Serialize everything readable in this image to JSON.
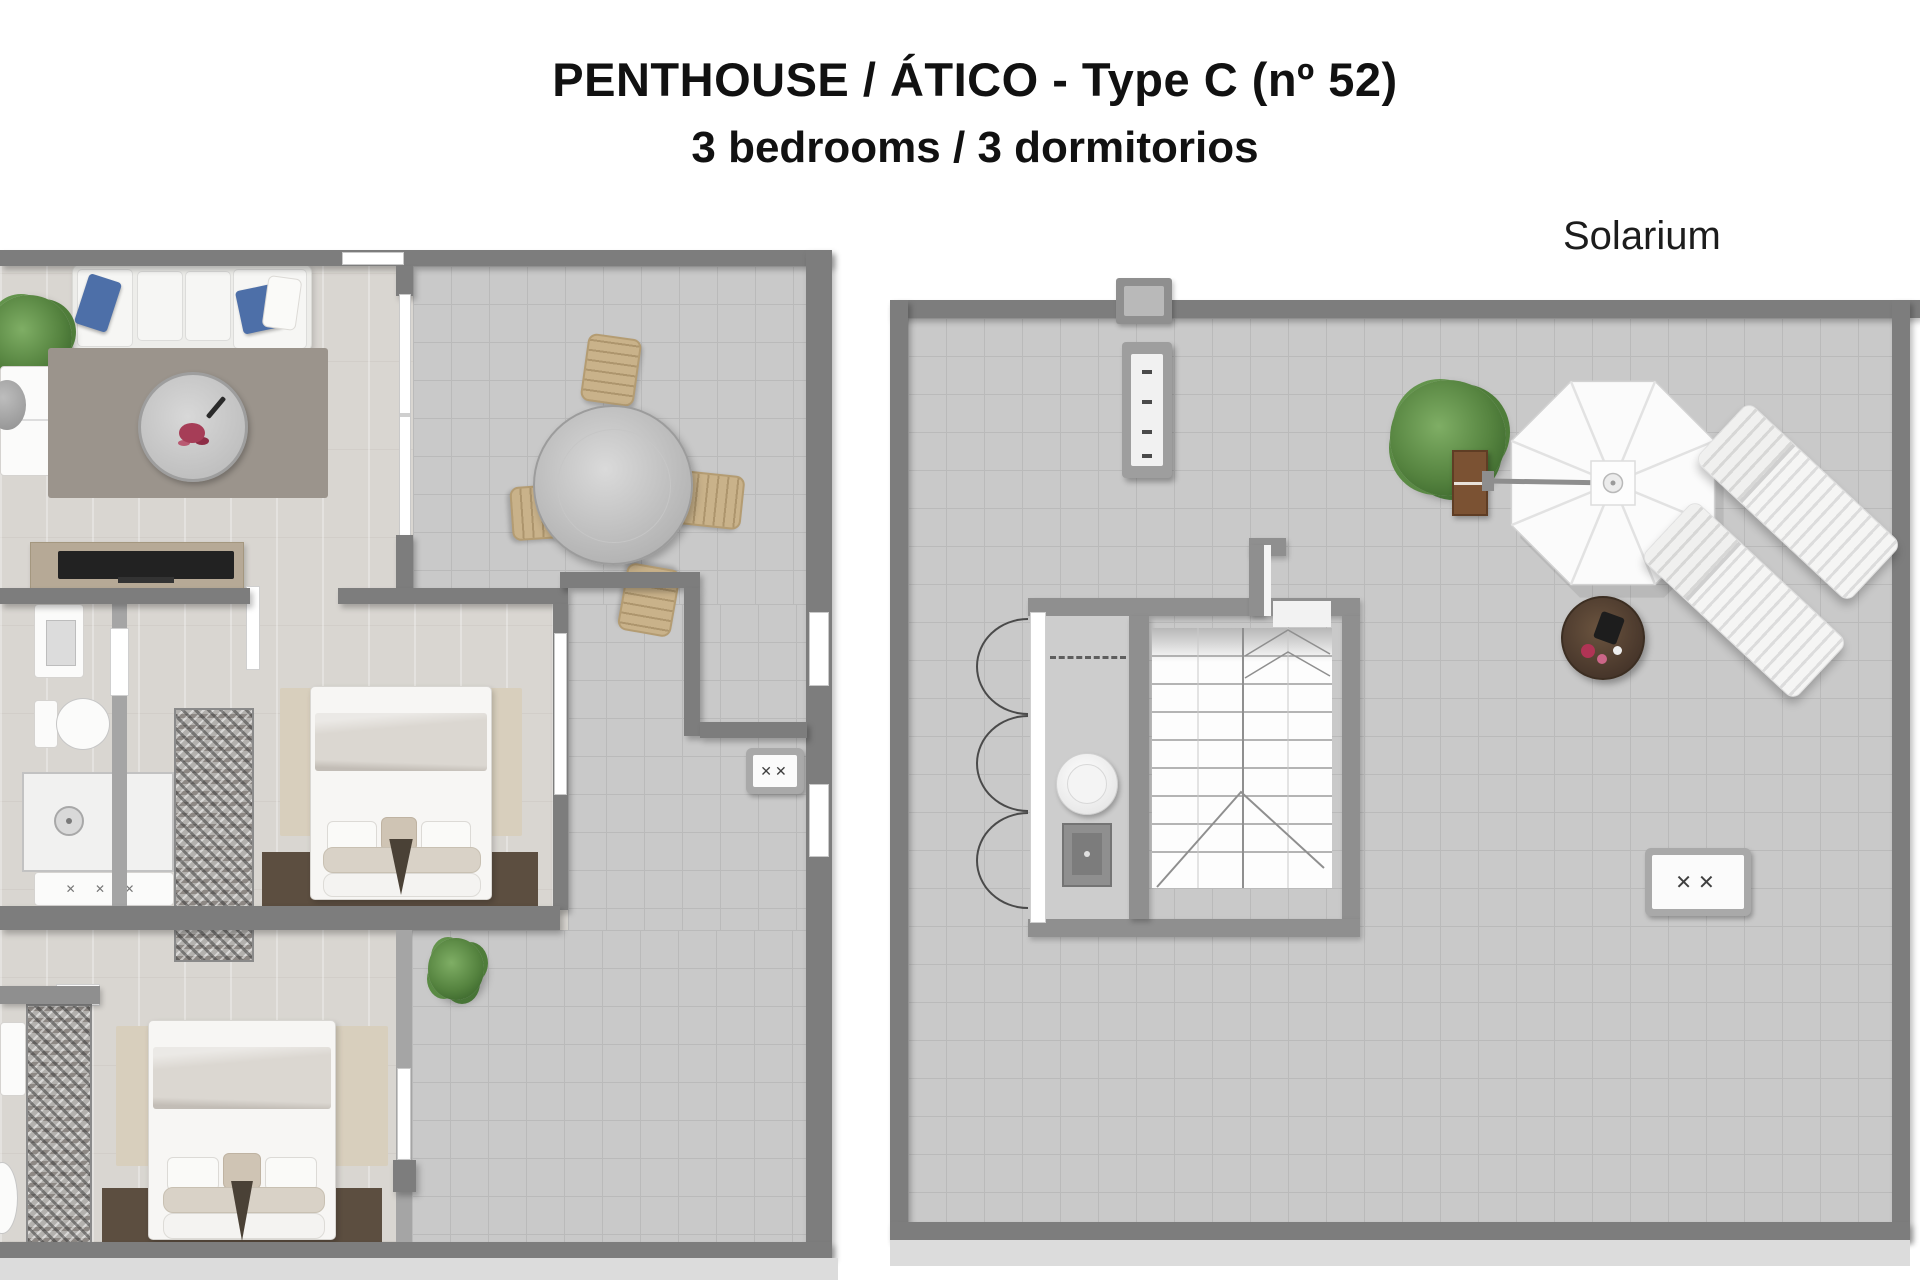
{
  "header": {
    "title": "PENTHOUSE / ÁTICO - Type C (nº 52)",
    "subtitle": "3 bedrooms / 3 dormitorios"
  },
  "labels": {
    "solarium": "Solarium"
  },
  "icons": {
    "vent_cross": "✕✕",
    "faucet_crosses": "✕ ✕ ✕"
  },
  "palette": {
    "background": "#ffffff",
    "wall_gray": "#7d7d7d",
    "indoor_floor": "#d9d6d1",
    "terrace_tile": "#c9c9c9",
    "accent_blue": "#4d6fa8",
    "headboard_brown": "#5c4e40",
    "rug_beige": "#d8cfbd",
    "plant_green": "#55833f",
    "planter_wood": "#7b5233"
  }
}
